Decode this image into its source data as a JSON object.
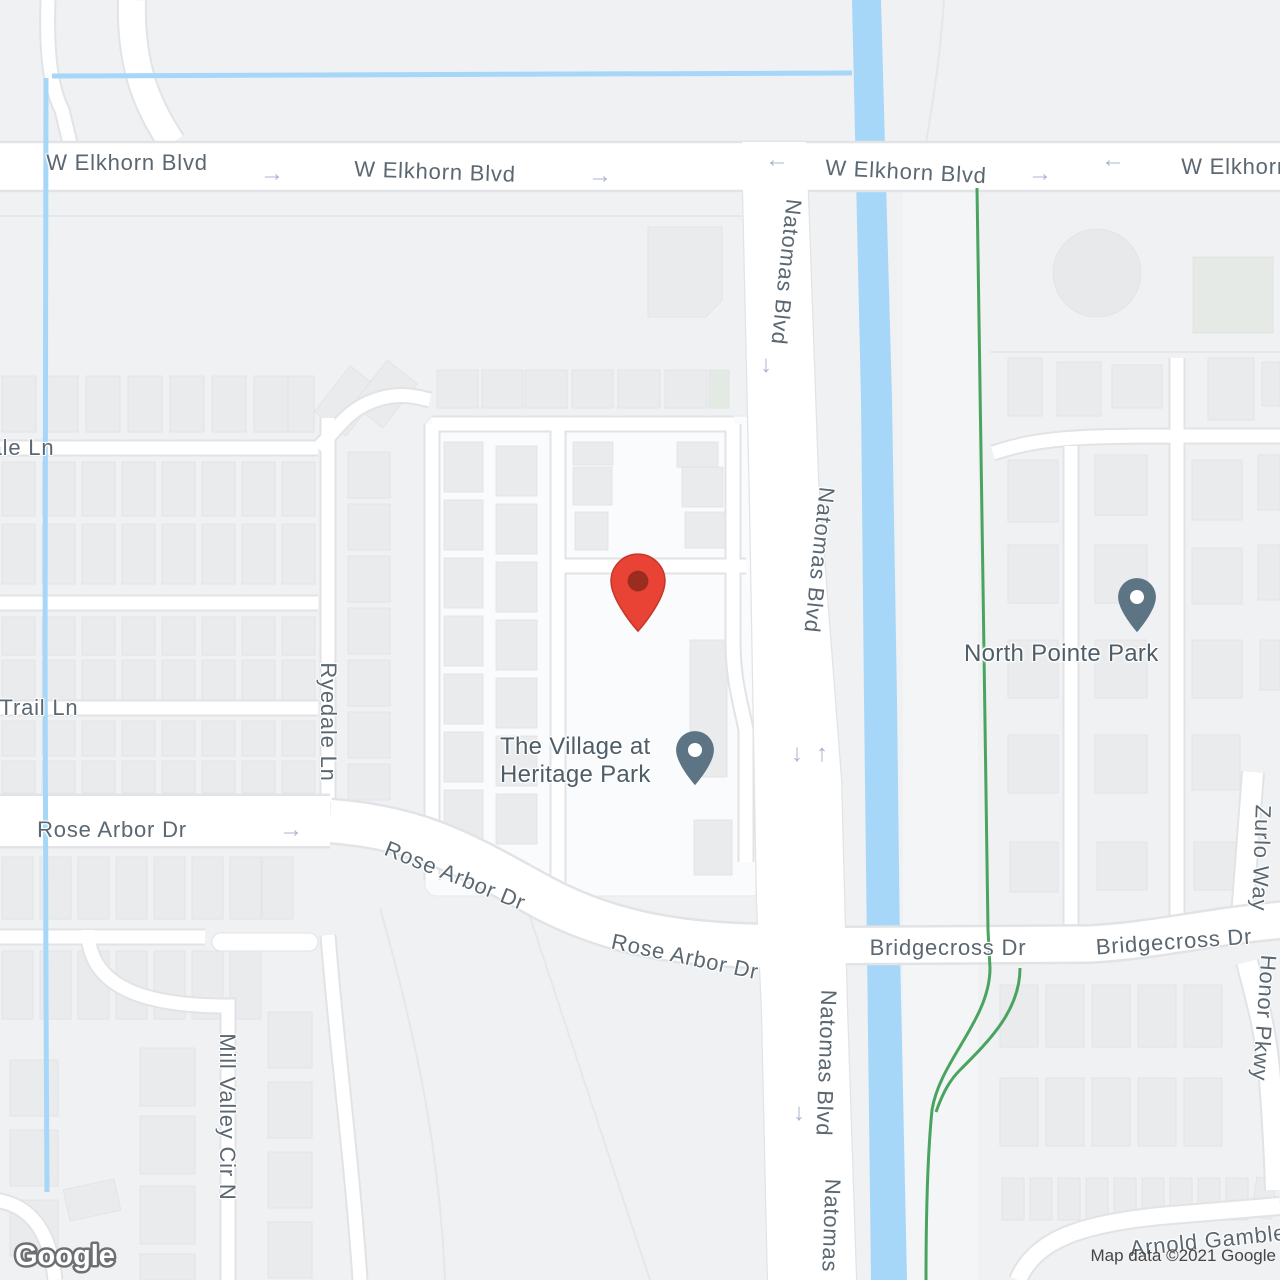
{
  "map": {
    "attribution": "Map data ©2021 Google",
    "watermark": "Google",
    "street_labels": {
      "w_elkhorn_blvd": "W Elkhorn Blvd",
      "natomas_blvd": "Natomas Blvd",
      "ale_ln": "ale Ln",
      "trail_ln": "Trail Ln",
      "ryedale_ln": "Ryedale Ln",
      "rose_arbor_dr": "Rose Arbor Dr",
      "bridgecross_dr": "Bridgecross Dr",
      "zurlo_way": "Zurlo Way",
      "honor_pkwy": "Honor Pkwy",
      "mill_valley_cir_n": "Mill Valley Cir N",
      "arnold_gamble": "Arnold Gamble"
    },
    "places": {
      "village_line1": "The Village at",
      "village_line2": "Heritage Park",
      "north_pointe_park": "North Pointe Park"
    },
    "icons": {
      "arrow_right": "→",
      "arrow_left": "←",
      "arrow_up": "↑",
      "arrow_down": "↓"
    },
    "colors": {
      "water": "#a6d7f9",
      "trail_green": "#4aa45f",
      "marker_red": "#e94335",
      "marker_red_dot": "#9a2d1f",
      "marker_slate": "#5d7485"
    }
  }
}
